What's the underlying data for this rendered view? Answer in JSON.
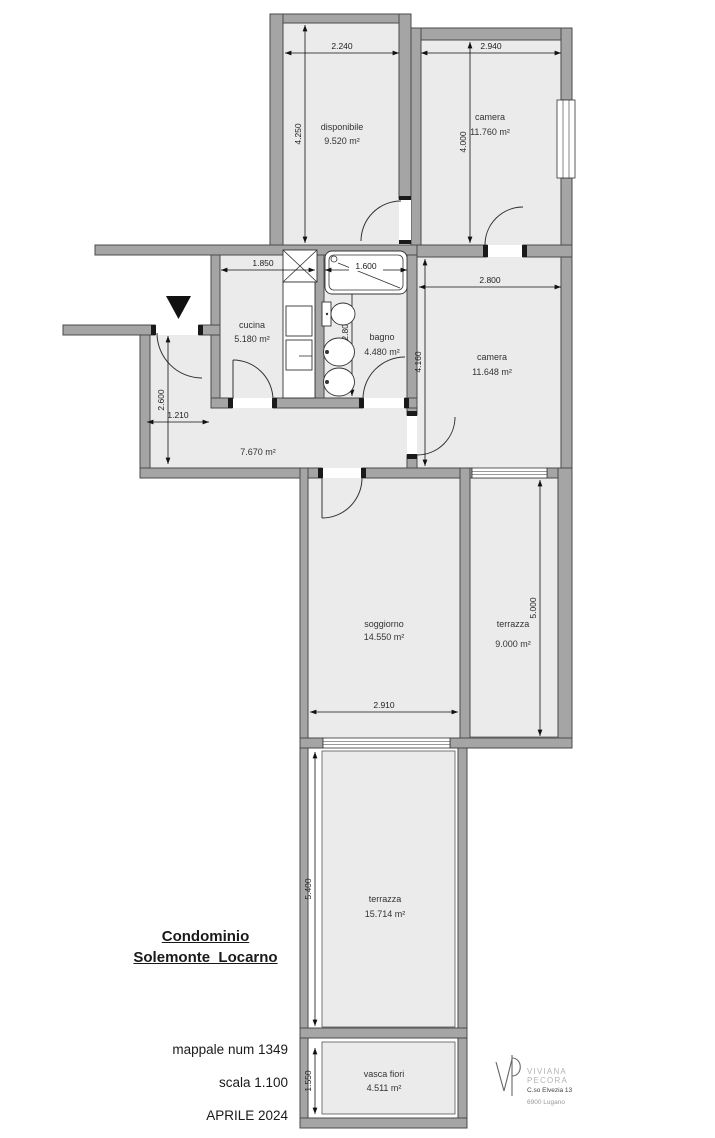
{
  "plan": {
    "rooms": {
      "disponibile": {
        "label": "disponibile",
        "area": "9.520 m²"
      },
      "camera_top": {
        "label": "camera",
        "area": "11.760 m²"
      },
      "cucina": {
        "label": "cucina",
        "area": "5.180 m²"
      },
      "bagno": {
        "label": "bagno",
        "area": "4.480 m²"
      },
      "camera_mid": {
        "label": "camera",
        "area": "11.648 m²"
      },
      "corridoio": {
        "area": "7.670 m²"
      },
      "soggiorno": {
        "label": "soggiorno",
        "area": "14.550 m²"
      },
      "terrazza_mid": {
        "label": "terrazza",
        "area": "9.000 m²"
      },
      "terrazza_bottom": {
        "label": "terrazza",
        "area": "15.714 m²"
      },
      "vasca_fiori": {
        "label": "vasca fiori",
        "area": "4.511 m²"
      }
    },
    "dims": {
      "disponibile_w": "2.240",
      "camera_top_w": "2.940",
      "disponibile_h": "4.250",
      "camera_top_h": "4.000",
      "cucina_w": "1.850",
      "bagno_w": "1.600",
      "bagno_h": "2.800",
      "camera_mid_w": "2.800",
      "camera_mid_h": "4.160",
      "entry_w": "1.210",
      "entry_h": "2.600",
      "soggiorno_w": "2.910",
      "terrazza_mid_h": "5.000",
      "terrazza_bottom_h": "5.400",
      "vasca_h": "1.550"
    }
  },
  "title_block": {
    "title_line1": "Condominio",
    "title_line2": "Solemonte_Locarno",
    "mappale": "mappale num 1349",
    "scale": "scala 1.100",
    "date": "APRILE 2024"
  },
  "logo": {
    "name_line1": "VIVIANA",
    "name_line2": "PECORA",
    "address": "C.so Elvezia 13",
    "city": "6900 Lugano"
  },
  "colors": {
    "wall": "#a5a5a5",
    "wall_outline": "#4a4a4a",
    "floor": "#ebebeb",
    "drawing_line": "#333333"
  }
}
